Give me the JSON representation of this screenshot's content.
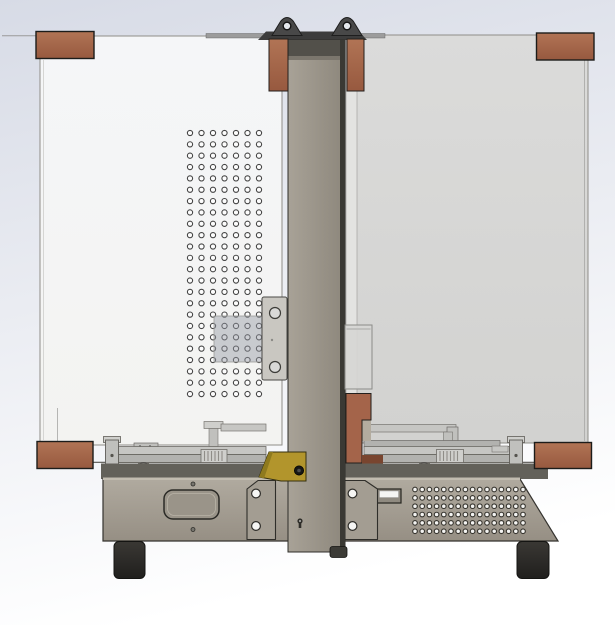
{
  "meta": {
    "description": "CAD render, front view of a vertical-column 3D printer / CNC machine with transparent side panels, copper corner brackets, perforated mounting plate, bed frame assembly and ventilated base",
    "view": "front"
  },
  "colors": {
    "bg_top": "#d7dbe6",
    "bg_bottom": "#ffffff",
    "panel_left_top": "#f5f6f8",
    "panel_left_bottom": "#f3f3f1",
    "panel_right_top": "#dbdbda",
    "panel_right_bottom": "#d2d2d0",
    "panel_edge_strip": "#e3e3e1",
    "copper_top": "#b17455",
    "copper_bottom": "#97593f",
    "copper_flat": "#a4644a",
    "copper_dark": "#79452f",
    "column_light": "#a8a297",
    "column_dark": "#8d877c",
    "column_cap": "#52504a",
    "column_band": "#7b766d",
    "column_edge": "#3a3934",
    "column_foot": "#3c3b36",
    "top_bar_dark": "#3c3c3c",
    "lug_fill": "#484848",
    "lug_hole": "#e6e9ee",
    "flange_gray": "#9c9c9c",
    "steel_light": "#cfcfcc",
    "steel_mid": "#c6c6c3",
    "steel_block": "#c0c0bd",
    "steel_shadow": "#b2b2af",
    "roller_gray": "#8b8b88",
    "base_top": "#b0aa9f",
    "base_bottom": "#968f84",
    "base_rim": "#63615a",
    "base_highlight": "#c2bcb0",
    "cutout_fill": "#9a9489",
    "switch_fill": "#8f8a80",
    "white_inset": "#f5f5f3",
    "gusset": "#a39d92",
    "plate_fill": "#c9c7c1",
    "plate_hole": "#d9d9d7",
    "box_fill": "#d6d6d4",
    "yellow": "#b2952c",
    "yellow_dark": "#8f7a1e",
    "bolt_black": "#171715",
    "foot_top": "#3a3834",
    "foot_bottom": "#201f1d",
    "hole_white": "#f6f6f4",
    "hole_ring": "#2f2e2a",
    "translucent_square": "rgba(148,154,163,0.45)"
  },
  "grids": {
    "perforation": {
      "cols": 7,
      "rows": 24,
      "x0": 190,
      "y0": 133,
      "dx": 11.5,
      "dy": 11.35,
      "r": 2.6,
      "fill": "#fdfdfd",
      "stroke": "#454545",
      "stroke_width": 1.1,
      "hole_name": "perforation-hole"
    },
    "vents": {
      "cols": 16,
      "rows": 6,
      "x0": 415,
      "y0": 489.5,
      "dx": 7.2,
      "dy": 8.35,
      "r": 2.3,
      "fill": "#f4f4f2",
      "stroke": "#37352f",
      "stroke_width": 1.1,
      "hole_name": "vent-hole"
    }
  },
  "parts": [
    "left transparent side panel",
    "right transparent side panel",
    "vertical Z column with dark cap",
    "copper column clamps",
    "two lifting lugs on top mounting bar",
    "perforated mounting plate (7 x 24 holes)",
    "translucent square plate over perforations",
    "motor mount plate with two bores",
    "electronics box outline",
    "copper corner brackets (4)",
    "copper column side bracket",
    "bed frame rails with leadscrew couplers and end posts",
    "yellow sensor bracket with bolt",
    "machine base with access cutout, switch cutout and ventilation grid (16 x 6)",
    "base gussets with bolt holes",
    "rubber feet (2)"
  ]
}
